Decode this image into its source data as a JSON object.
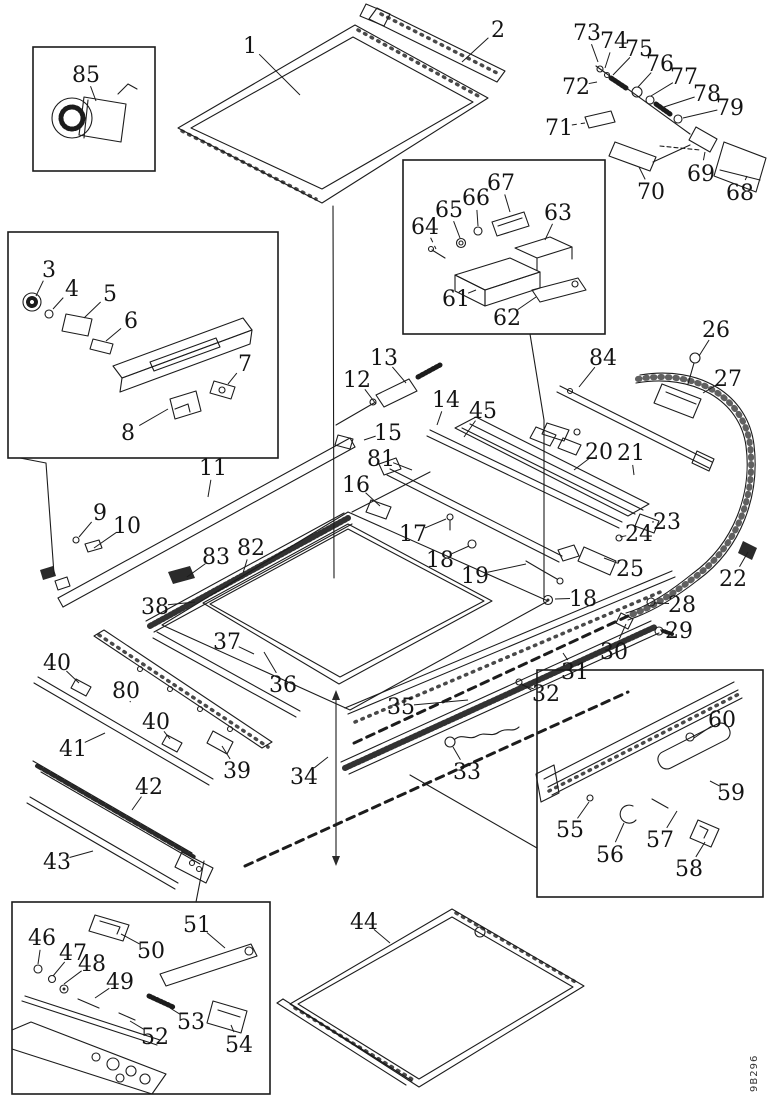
{
  "diagram": {
    "title": "Sunroof exploded parts diagram",
    "figure_code": "9B296",
    "ink_color": "#1c1c1c",
    "paper_color": "#ffffff",
    "detail_boxes": [
      {
        "id": "detail-box-85",
        "x": 33,
        "y": 47,
        "w": 122,
        "h": 124
      },
      {
        "id": "detail-box-3-8",
        "x": 8,
        "y": 232,
        "w": 270,
        "h": 226
      },
      {
        "id": "detail-box-61-67",
        "x": 403,
        "y": 160,
        "w": 202,
        "h": 174
      },
      {
        "id": "detail-box-55-60",
        "x": 537,
        "y": 670,
        "w": 226,
        "h": 227
      },
      {
        "id": "detail-box-46-54",
        "x": 12,
        "y": 902,
        "w": 258,
        "h": 192
      }
    ],
    "callouts": [
      {
        "label": "1",
        "x": 250,
        "y": 45,
        "lx": 300,
        "ly": 95
      },
      {
        "label": "2",
        "x": 498,
        "y": 29,
        "lx": 462,
        "ly": 62
      },
      {
        "label": "3",
        "x": 49,
        "y": 269,
        "lx": 36,
        "ly": 296
      },
      {
        "label": "4",
        "x": 72,
        "y": 288,
        "lx": 53,
        "ly": 309
      },
      {
        "label": "5",
        "x": 110,
        "y": 293,
        "lx": 84,
        "ly": 318
      },
      {
        "label": "6",
        "x": 131,
        "y": 320,
        "lx": 106,
        "ly": 341
      },
      {
        "label": "7",
        "x": 245,
        "y": 363,
        "lx": 228,
        "ly": 384
      },
      {
        "label": "8",
        "x": 128,
        "y": 432,
        "lx": 168,
        "ly": 409
      },
      {
        "label": "9",
        "x": 100,
        "y": 512,
        "lx": 79,
        "ly": 537
      },
      {
        "label": "10",
        "x": 127,
        "y": 525,
        "lx": 94,
        "ly": 548
      },
      {
        "label": "11",
        "x": 213,
        "y": 467,
        "lx": 208,
        "ly": 497
      },
      {
        "label": "12",
        "x": 357,
        "y": 379,
        "lx": 376,
        "ly": 404
      },
      {
        "label": "13",
        "x": 384,
        "y": 357,
        "lx": 406,
        "ly": 383
      },
      {
        "label": "14",
        "x": 446,
        "y": 399,
        "lx": 437,
        "ly": 425
      },
      {
        "label": "15",
        "x": 388,
        "y": 432,
        "lx": 364,
        "ly": 440
      },
      {
        "label": "16",
        "x": 356,
        "y": 484,
        "lx": 380,
        "ly": 506
      },
      {
        "label": "17",
        "x": 413,
        "y": 533,
        "lx": 446,
        "ly": 519
      },
      {
        "label": "18",
        "x": 440,
        "y": 559,
        "lx": 469,
        "ly": 546
      },
      {
        "label": "19",
        "x": 475,
        "y": 575,
        "lx": 526,
        "ly": 564
      },
      {
        "label": "18",
        "x": 583,
        "y": 598,
        "lx": 555,
        "ly": 599
      },
      {
        "label": "20",
        "x": 599,
        "y": 451,
        "lx": 574,
        "ly": 470
      },
      {
        "label": "21",
        "x": 631,
        "y": 452,
        "lx": 634,
        "ly": 475
      },
      {
        "label": "22",
        "x": 733,
        "y": 578,
        "lx": 748,
        "ly": 552
      },
      {
        "label": "23",
        "x": 667,
        "y": 521,
        "lx": 652,
        "ly": 522
      },
      {
        "label": "24",
        "x": 639,
        "y": 533,
        "lx": 620,
        "ly": 537
      },
      {
        "label": "25",
        "x": 630,
        "y": 568,
        "lx": 604,
        "ly": 558
      },
      {
        "label": "26",
        "x": 716,
        "y": 329,
        "lx": 699,
        "ly": 356
      },
      {
        "label": "27",
        "x": 728,
        "y": 378,
        "lx": 703,
        "ly": 393
      },
      {
        "label": "28",
        "x": 682,
        "y": 604,
        "lx": 654,
        "ly": 603
      },
      {
        "label": "29",
        "x": 679,
        "y": 630,
        "lx": 660,
        "ly": 630
      },
      {
        "label": "30",
        "x": 614,
        "y": 651,
        "lx": 626,
        "ly": 624
      },
      {
        "label": "31",
        "x": 575,
        "y": 671,
        "lx": 563,
        "ly": 653
      },
      {
        "label": "32",
        "x": 546,
        "y": 693,
        "lx": 522,
        "ly": 685
      },
      {
        "label": "33",
        "x": 467,
        "y": 771,
        "lx": 453,
        "ly": 747
      },
      {
        "label": "34",
        "x": 304,
        "y": 776,
        "lx": 328,
        "ly": 757
      },
      {
        "label": "35",
        "x": 401,
        "y": 706,
        "lx": 468,
        "ly": 700
      },
      {
        "label": "36",
        "x": 283,
        "y": 684,
        "lx": 264,
        "ly": 652
      },
      {
        "label": "37",
        "x": 227,
        "y": 641,
        "lx": 254,
        "ly": 654
      },
      {
        "label": "38",
        "x": 155,
        "y": 606,
        "lx": 195,
        "ly": 602
      },
      {
        "label": "39",
        "x": 237,
        "y": 770,
        "lx": 222,
        "ly": 746
      },
      {
        "label": "40",
        "x": 57,
        "y": 662,
        "lx": 79,
        "ly": 683
      },
      {
        "label": "40",
        "x": 156,
        "y": 721,
        "lx": 170,
        "ly": 739
      },
      {
        "label": "41",
        "x": 73,
        "y": 748,
        "lx": 105,
        "ly": 733
      },
      {
        "label": "42",
        "x": 149,
        "y": 786,
        "lx": 132,
        "ly": 810
      },
      {
        "label": "43",
        "x": 57,
        "y": 861,
        "lx": 93,
        "ly": 851
      },
      {
        "label": "44",
        "x": 364,
        "y": 921,
        "lx": 390,
        "ly": 943
      },
      {
        "label": "45",
        "x": 483,
        "y": 410,
        "lx": 464,
        "ly": 437
      },
      {
        "label": "46",
        "x": 42,
        "y": 937,
        "lx": 38,
        "ly": 964
      },
      {
        "label": "47",
        "x": 73,
        "y": 952,
        "lx": 53,
        "ly": 976
      },
      {
        "label": "48",
        "x": 92,
        "y": 963,
        "lx": 64,
        "ly": 984
      },
      {
        "label": "49",
        "x": 120,
        "y": 981,
        "lx": 95,
        "ly": 998
      },
      {
        "label": "50",
        "x": 151,
        "y": 950,
        "lx": 121,
        "ly": 934
      },
      {
        "label": "51",
        "x": 197,
        "y": 924,
        "lx": 225,
        "ly": 948
      },
      {
        "label": "52",
        "x": 155,
        "y": 1036,
        "lx": 130,
        "ly": 1021
      },
      {
        "label": "53",
        "x": 191,
        "y": 1021,
        "lx": 170,
        "ly": 1008
      },
      {
        "label": "54",
        "x": 239,
        "y": 1044,
        "lx": 231,
        "ly": 1025
      },
      {
        "label": "55",
        "x": 570,
        "y": 829,
        "lx": 589,
        "ly": 802
      },
      {
        "label": "56",
        "x": 610,
        "y": 854,
        "lx": 624,
        "ly": 823
      },
      {
        "label": "57",
        "x": 660,
        "y": 839,
        "lx": 677,
        "ly": 811
      },
      {
        "label": "58",
        "x": 689,
        "y": 868,
        "lx": 705,
        "ly": 842
      },
      {
        "label": "59",
        "x": 731,
        "y": 792,
        "lx": 710,
        "ly": 781
      },
      {
        "label": "60",
        "x": 722,
        "y": 719,
        "lx": 694,
        "ly": 738
      },
      {
        "label": "61",
        "x": 456,
        "y": 298,
        "lx": 476,
        "ly": 290
      },
      {
        "label": "62",
        "x": 507,
        "y": 317,
        "lx": 536,
        "ly": 297
      },
      {
        "label": "63",
        "x": 558,
        "y": 212,
        "lx": 545,
        "ly": 240
      },
      {
        "label": "64",
        "x": 425,
        "y": 226,
        "lx": 436,
        "ly": 249,
        "dashed": true
      },
      {
        "label": "65",
        "x": 449,
        "y": 209,
        "lx": 460,
        "ly": 238
      },
      {
        "label": "66",
        "x": 476,
        "y": 197,
        "lx": 478,
        "ly": 226
      },
      {
        "label": "67",
        "x": 501,
        "y": 182,
        "lx": 510,
        "ly": 212
      },
      {
        "label": "68",
        "x": 740,
        "y": 192,
        "lx": 747,
        "ly": 176
      },
      {
        "label": "69",
        "x": 701,
        "y": 173,
        "lx": 705,
        "ly": 152
      },
      {
        "label": "70",
        "x": 651,
        "y": 191,
        "lx": 639,
        "ly": 167
      },
      {
        "label": "71",
        "x": 559,
        "y": 127,
        "lx": 585,
        "ly": 123,
        "dashed": true
      },
      {
        "label": "72",
        "x": 576,
        "y": 86,
        "lx": 597,
        "ly": 82
      },
      {
        "label": "73",
        "x": 587,
        "y": 32,
        "lx": 598,
        "ly": 62
      },
      {
        "label": "74",
        "x": 614,
        "y": 40,
        "lx": 605,
        "ly": 68
      },
      {
        "label": "75",
        "x": 639,
        "y": 48,
        "lx": 613,
        "ly": 75
      },
      {
        "label": "76",
        "x": 660,
        "y": 63,
        "lx": 638,
        "ly": 87
      },
      {
        "label": "77",
        "x": 684,
        "y": 76,
        "lx": 651,
        "ly": 96
      },
      {
        "label": "78",
        "x": 707,
        "y": 93,
        "lx": 664,
        "ly": 107
      },
      {
        "label": "79",
        "x": 730,
        "y": 107,
        "lx": 683,
        "ly": 118
      },
      {
        "label": "80",
        "x": 126,
        "y": 690,
        "lx": 130,
        "ly": 701
      },
      {
        "label": "81",
        "x": 381,
        "y": 458,
        "lx": 412,
        "ly": 470
      },
      {
        "label": "82",
        "x": 251,
        "y": 547,
        "lx": 243,
        "ly": 573
      },
      {
        "label": "83",
        "x": 216,
        "y": 556,
        "lx": 187,
        "ly": 577
      },
      {
        "label": "84",
        "x": 603,
        "y": 357,
        "lx": 579,
        "ly": 387
      },
      {
        "label": "85",
        "x": 86,
        "y": 74,
        "lx": 96,
        "ly": 101
      }
    ]
  }
}
